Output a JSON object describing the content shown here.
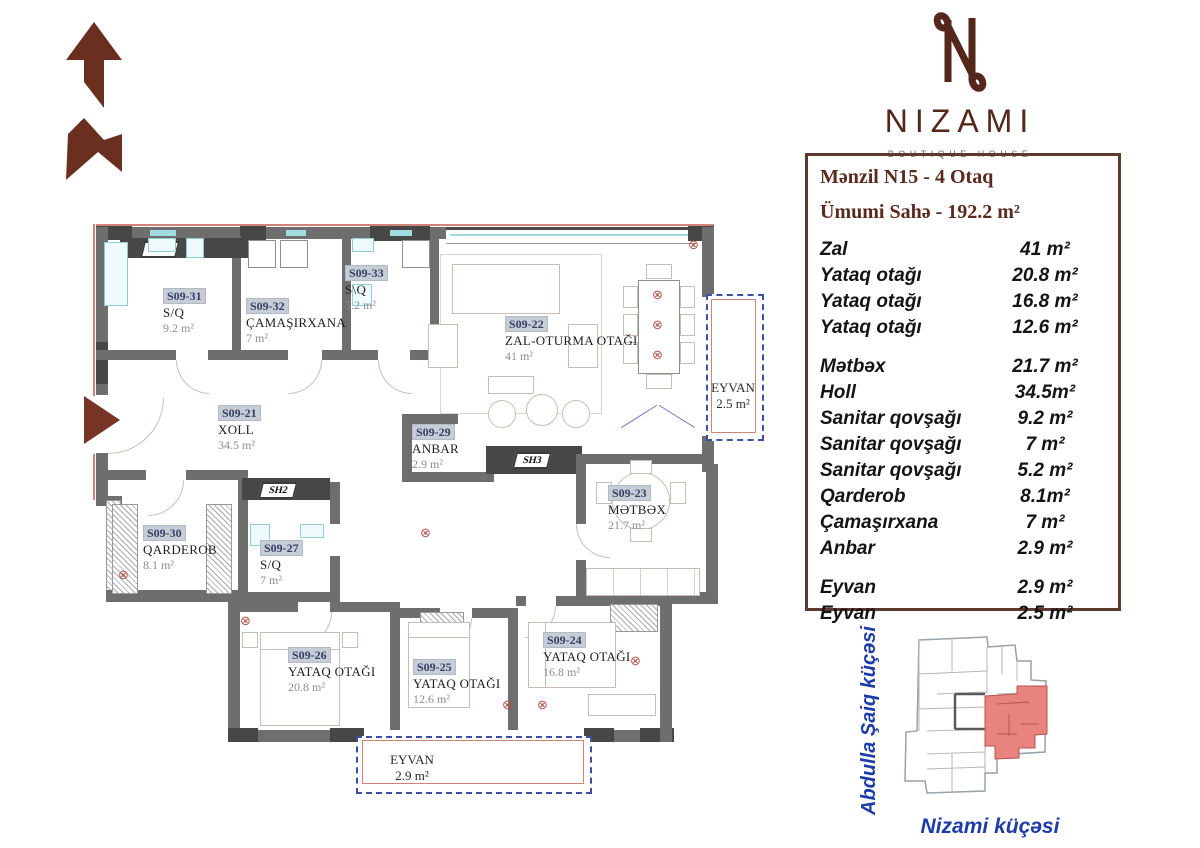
{
  "logo": {
    "name": "NIZAMI",
    "tagline": "BOUTIQUE HOUSE"
  },
  "info_panel": {
    "title": "Mənzil N15 - 4 Otaq",
    "subtitle": "Ümumi Sahə - 192.2 m²",
    "groups": [
      {
        "rows": [
          {
            "name": "Zal",
            "area": "41 m²"
          },
          {
            "name": "Yataq otağı",
            "area": "20.8 m²"
          },
          {
            "name": "Yataq otağı",
            "area": "16.8 m²"
          },
          {
            "name": "Yataq otağı",
            "area": "12.6 m²"
          }
        ]
      },
      {
        "rows": [
          {
            "name": "Mətbəx",
            "area": "21.7 m²"
          },
          {
            "name": "Holl",
            "area": "34.5m²"
          },
          {
            "name": "Sanitar qovşağı",
            "area": "9.2 m²"
          },
          {
            "name": "Sanitar qovşağı",
            "area": "7 m²"
          },
          {
            "name": "Sanitar qovşağı",
            "area": "5.2 m²"
          },
          {
            "name": "Qarderob",
            "area": "8.1m²"
          },
          {
            "name": "Çamaşırxana",
            "area": "7 m²"
          },
          {
            "name": "Anbar",
            "area": "2.9 m²"
          }
        ]
      },
      {
        "rows": [
          {
            "name": "Eyvan",
            "area": "2.9 m²"
          },
          {
            "name": "Eyvan",
            "area": "2.5 m²"
          }
        ]
      }
    ]
  },
  "floor_plan": {
    "rooms": [
      {
        "id": "S09-31",
        "name": "S/Q",
        "area": "9.2 m²"
      },
      {
        "id": "S09-32",
        "name": "ÇAMAŞIRXANA",
        "area": "7 m²"
      },
      {
        "id": "S09-33",
        "name": "S\\Q",
        "area": "5.2 m²"
      },
      {
        "id": "S09-22",
        "name": "ZAL-OTURMA OTAĞI",
        "area": "41 m²"
      },
      {
        "id": "S09-21",
        "name": "XOLL",
        "area": "34.5 m²"
      },
      {
        "id": "S09-29",
        "name": "ANBAR",
        "area": "2.9 m²"
      },
      {
        "id": "S09-23",
        "name": "MƏTBƏX",
        "area": "21.7 m²"
      },
      {
        "id": "S09-30",
        "name": "QARDEROB",
        "area": "8.1 m²"
      },
      {
        "id": "S09-27",
        "name": "S/Q",
        "area": "7 m²"
      },
      {
        "id": "S09-26",
        "name": "YATAQ OTAĞI",
        "area": "20.8 m²"
      },
      {
        "id": "S09-25",
        "name": "YATAQ OTAĞI",
        "area": "12.6 m²"
      },
      {
        "id": "S09-24",
        "name": "YATAQ OTAĞI",
        "area": "16.8 m²"
      }
    ],
    "balconies": [
      {
        "name": "EYVAN",
        "area": "2.5 m²"
      },
      {
        "name": "EYVAN",
        "area": "2.9 m²"
      }
    ],
    "shafts": [
      {
        "label": "SH4"
      },
      {
        "label": "SH3"
      },
      {
        "label": "SH2"
      }
    ]
  },
  "mini_map": {
    "street_left": "Abdulla Şaiq küçəsi",
    "street_bottom": "Nizami küçəsi"
  },
  "colors": {
    "brand": "#54271b",
    "panel_border": "#5d392e",
    "highlight": "#e8837f",
    "street_blue": "#1d3ca8"
  }
}
